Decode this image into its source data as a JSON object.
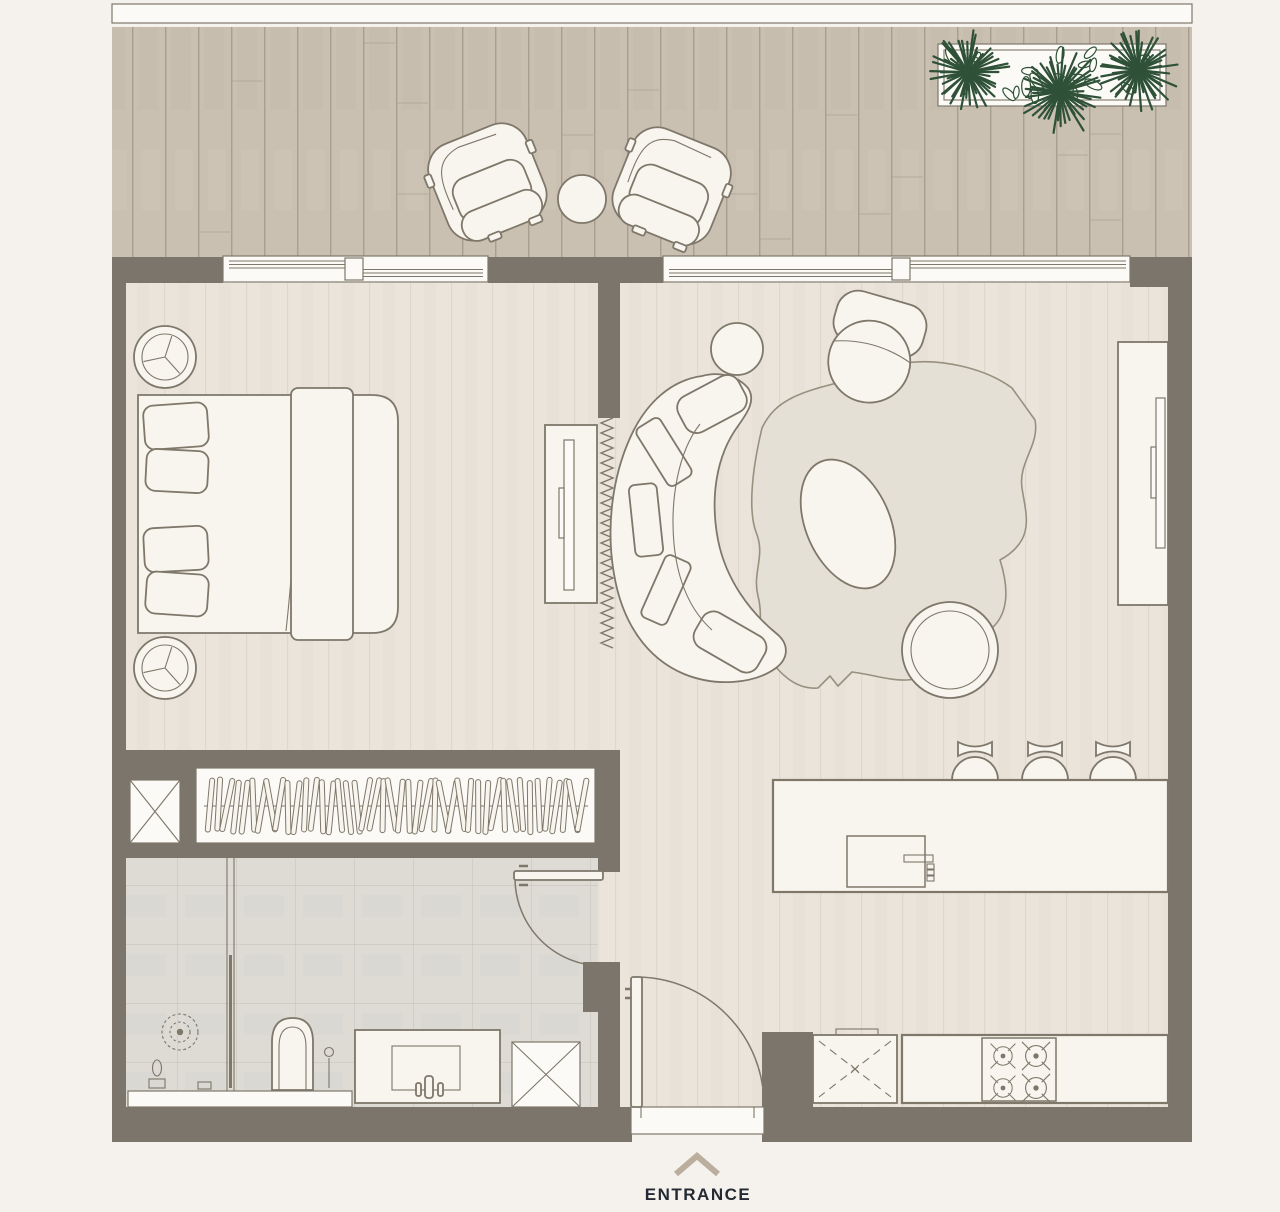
{
  "title": "One-bedroom apartment floor plan",
  "entrance": {
    "label": "ENTRANCE",
    "arrow": "chevron-up-icon"
  },
  "colors": {
    "page_bg": "#f5f2ed",
    "wall": "#7b756c",
    "deck": "#c9c0b2",
    "deck_line": "#a99f8f",
    "floor": "#eae4db",
    "floor_line": "#ded7cb",
    "tile": "#dddbd4",
    "tile_line": "#c8c5bd",
    "furn": "#f8f5ee",
    "outline": "#7e776a",
    "rug": "#e5e0d6",
    "plant": "#2f5138",
    "glass": "#fbfaf6",
    "entrance_text": "#232a34",
    "entrance_arrow": "#bcae9c"
  },
  "plan": {
    "rooms": [
      {
        "id": "balcony",
        "items": [
          "lounge-chair",
          "lounge-chair",
          "round-side-table",
          "planter-box-with-plants"
        ]
      },
      {
        "id": "bedroom",
        "items": [
          "double-bed",
          "pillows",
          "bed-runner",
          "nightstand",
          "nightstand",
          "dresser-with-tv",
          "curtain-zigzag"
        ]
      },
      {
        "id": "wardrobe",
        "items": [
          "hanging-rail-with-hangers",
          "service-shaft"
        ]
      },
      {
        "id": "living-room",
        "items": [
          "curved-sofa",
          "armchair",
          "round-side-table",
          "organic-area-rug",
          "egg-coffee-table",
          "round-pouf",
          "tv-console"
        ]
      },
      {
        "id": "kitchen",
        "items": [
          "island-counter",
          "island-sink",
          "bar-stool",
          "bar-stool",
          "bar-stool",
          "washer-dashed-box",
          "base-counter",
          "hob-4-burners"
        ]
      },
      {
        "id": "bathroom",
        "items": [
          "rain-shower-head",
          "glass-partition",
          "toilet",
          "vanity-with-sink",
          "service-shaft"
        ]
      },
      {
        "id": "hallway",
        "items": [
          "entrance-door-swing",
          "bathroom-door-swing"
        ]
      }
    ],
    "windows": [
      "bedroom-sliding-window",
      "living-sliding-window"
    ],
    "doors": [
      "entrance-door",
      "bathroom-door"
    ]
  }
}
